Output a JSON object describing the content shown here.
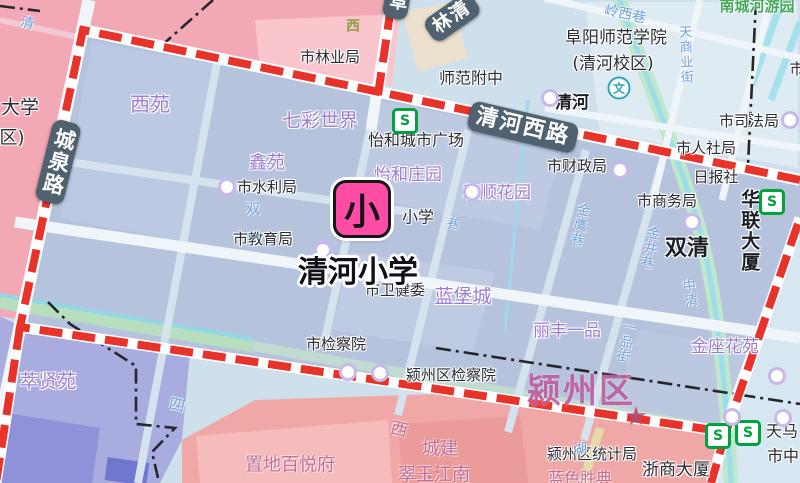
{
  "map": {
    "school_label": "清河小学",
    "marker": {
      "char": "小"
    },
    "colors": {
      "boundary_red": "#e8332b",
      "district_fill": "#b5c3dd",
      "base_lightblue": "#cfe0ed",
      "pink_northwest": "#f2a9b5",
      "salmon_south": "#f0a8a6",
      "purple_southwest": "#a8acde",
      "marker_pink": "#ff4da6",
      "pill_bg": "#50626f",
      "residential_purple": "#9d7bd0",
      "street_blue": "#6fa0dc",
      "metro_green": "#00a33e",
      "park_green": "#b7dfbf",
      "water_cyan": "#93d6e6"
    },
    "labels": [
      {
        "n": "road-pill-chengquanlu",
        "t": "城泉路",
        "cls": "pill",
        "x": 58,
        "y": 162,
        "s": 21,
        "r": 14,
        "v": true,
        "i": false
      },
      {
        "n": "road-pill-qinghexilu",
        "t": "清河西路",
        "cls": "pill",
        "x": 523,
        "y": 127,
        "s": 22,
        "r": 13,
        "i": false
      },
      {
        "n": "road-pill-linqing",
        "t": "林清",
        "cls": "pill",
        "x": 452,
        "y": 17,
        "s": 19,
        "r": -35,
        "i": false
      },
      {
        "n": "road-pill-fu",
        "t": "阜",
        "cls": "pill",
        "x": 397,
        "y": 2,
        "s": 18,
        "r": 10,
        "v": true,
        "i": false
      },
      {
        "n": "poi-shilinyeju",
        "t": "市林业局",
        "cls": "poi",
        "x": 330,
        "y": 57,
        "i": true
      },
      {
        "n": "poi-shifanfuzhong",
        "t": "师范附中",
        "cls": "poi",
        "x": 471,
        "y": 78,
        "s": 16,
        "i": true
      },
      {
        "n": "poi-qinghe",
        "t": "清河",
        "cls": "poib",
        "x": 572,
        "y": 103,
        "s": 17,
        "i": true
      },
      {
        "n": "poi-fuyangshifanxueyuan",
        "t": "阜阳师范学院",
        "cls": "poi",
        "x": 616,
        "y": 38,
        "s": 17,
        "i": true
      },
      {
        "n": "poi-qinghexiaoqu",
        "t": "(清河校区)",
        "cls": "poi",
        "x": 613,
        "y": 64,
        "s": 17,
        "i": true
      },
      {
        "n": "poi-shisifaju",
        "t": "市司法局",
        "cls": "poi",
        "x": 749,
        "y": 121,
        "i": true
      },
      {
        "n": "poi-shirensheju",
        "t": "市人社局",
        "cls": "poi",
        "x": 706,
        "y": 148,
        "i": true
      },
      {
        "n": "poi-ribaoshe",
        "t": "日报社",
        "cls": "poi",
        "x": 716,
        "y": 177,
        "i": true
      },
      {
        "n": "poi-shicaizhengju",
        "t": "市财政局",
        "cls": "poi",
        "x": 577,
        "y": 166,
        "i": true
      },
      {
        "n": "poi-shishangwuju",
        "t": "市商务局",
        "cls": "poi",
        "x": 667,
        "y": 201,
        "i": true
      },
      {
        "n": "poi-shuangqing",
        "t": "双清",
        "cls": "poib",
        "x": 687,
        "y": 249,
        "s": 22,
        "i": true
      },
      {
        "n": "poi-hualiandasha",
        "t": "华联大厦",
        "cls": "poib",
        "x": 749,
        "y": 231,
        "s": 19,
        "v": true,
        "i": true
      },
      {
        "n": "poi-shishuiliju",
        "t": "市水利局",
        "cls": "poi",
        "x": 267,
        "y": 187,
        "i": true
      },
      {
        "n": "poi-shijiaoyuju",
        "t": "市教育局",
        "cls": "poi",
        "x": 263,
        "y": 239,
        "i": true
      },
      {
        "n": "poi-yihechengshiguangchang",
        "t": "怡和城市广场",
        "cls": "poi",
        "x": 416,
        "y": 140,
        "s": 16,
        "i": true
      },
      {
        "n": "poi-xiaoxue-partial",
        "t": "小学",
        "cls": "poi",
        "x": 418,
        "y": 217,
        "s": 16,
        "i": true
      },
      {
        "n": "poi-shiweijianwei",
        "t": "市卫健委",
        "cls": "poi",
        "x": 395,
        "y": 290,
        "i": true
      },
      {
        "n": "poi-shijianchayuan",
        "t": "市检察院",
        "cls": "poi",
        "x": 336,
        "y": 344,
        "i": true
      },
      {
        "n": "poi-yingzhouqujianchayuan",
        "t": "颍州区检察院",
        "cls": "poi",
        "x": 451,
        "y": 375,
        "i": true
      },
      {
        "n": "poi-yingzhouqutongjiju",
        "t": "颍州区统计局",
        "cls": "poi",
        "x": 592,
        "y": 454,
        "i": true
      },
      {
        "n": "poi-zheshangdasha",
        "t": "浙商大厦",
        "cls": "poi",
        "x": 676,
        "y": 470,
        "s": 17,
        "i": true
      },
      {
        "n": "poi-tianma",
        "t": "天马",
        "cls": "poi",
        "x": 782,
        "y": 431,
        "s": 16,
        "i": true
      },
      {
        "n": "poi-shizhong",
        "t": "市中",
        "cls": "poi",
        "x": 783,
        "y": 456,
        "s": 16,
        "i": true
      },
      {
        "n": "poi-shi-partial",
        "t": "市",
        "cls": "poi",
        "x": 797,
        "y": 69,
        "i": true
      },
      {
        "n": "poi-daxue-partial",
        "t": "大学",
        "cls": "poi",
        "x": 20,
        "y": 108,
        "s": 19,
        "i": false
      },
      {
        "n": "poi-qu-partial",
        "t": "区)",
        "cls": "poi",
        "x": 12,
        "y": 138,
        "s": 18,
        "i": false
      },
      {
        "n": "res-xiyuan",
        "t": "西苑",
        "cls": "res",
        "x": 150,
        "y": 105,
        "s": 20,
        "i": true
      },
      {
        "n": "res-qicaishijie",
        "t": "七彩世界",
        "cls": "res",
        "x": 320,
        "y": 121,
        "s": 19,
        "i": true
      },
      {
        "n": "res-xinyuan",
        "t": "鑫苑",
        "cls": "res",
        "x": 267,
        "y": 163,
        "s": 18,
        "i": true
      },
      {
        "n": "res-yihezhuangyuan",
        "t": "怡和庄园",
        "cls": "res",
        "x": 408,
        "y": 175,
        "s": 17,
        "i": true
      },
      {
        "n": "res-heshunhuayuan",
        "t": "和顺花园",
        "cls": "res",
        "x": 497,
        "y": 193,
        "s": 17,
        "i": true
      },
      {
        "n": "res-lanbaocheng",
        "t": "蓝堡城",
        "cls": "res",
        "x": 463,
        "y": 297,
        "s": 19,
        "i": true
      },
      {
        "n": "res-lifengyipin",
        "t": "丽丰一品",
        "cls": "res",
        "x": 567,
        "y": 331,
        "s": 17,
        "i": true
      },
      {
        "n": "res-jinzuohuayuan",
        "t": "金座花苑",
        "cls": "res",
        "x": 725,
        "y": 347,
        "s": 17,
        "i": true
      },
      {
        "n": "res-cuixianyuan",
        "t": "萃贤苑",
        "cls": "res",
        "x": 48,
        "y": 382,
        "s": 19,
        "i": true
      },
      {
        "n": "res-zhidibaiyuefu",
        "t": "置地百悦府",
        "cls": "mauve",
        "x": 290,
        "y": 465,
        "s": 18,
        "i": true
      },
      {
        "n": "res-chengjian",
        "t": "城建",
        "cls": "mauve",
        "x": 440,
        "y": 449,
        "s": 18,
        "i": true
      },
      {
        "n": "res-cuiyujiangnan",
        "t": "翠玉江南",
        "cls": "mauve",
        "x": 434,
        "y": 475,
        "s": 18,
        "i": true
      },
      {
        "n": "res-lanseshengdian",
        "t": "蓝色胜典",
        "cls": "mauve",
        "x": 580,
        "y": 478,
        "s": 16,
        "i": true
      },
      {
        "n": "district-label-yingzhouqu",
        "t": "颍州区",
        "cls": "district",
        "x": 581,
        "y": 392,
        "s": 34,
        "i": false
      },
      {
        "n": "street-qing",
        "t": "清",
        "cls": "street",
        "x": 27,
        "y": 24,
        "s": 14,
        "r": 15,
        "i": false
      },
      {
        "n": "street-lingxixiang",
        "t": "岭西巷",
        "cls": "street",
        "x": 625,
        "y": 15,
        "s": 14,
        "r": 12,
        "i": false
      },
      {
        "n": "street-tianshangyejie",
        "t": "天商业街",
        "cls": "street",
        "x": 684,
        "y": 55,
        "s": 13,
        "r": -2,
        "v": true,
        "i": false
      },
      {
        "n": "street-jinyingxiang",
        "t": "金鹰巷",
        "cls": "street",
        "x": 578,
        "y": 225,
        "s": 13,
        "r": 12,
        "v": true,
        "i": false
      },
      {
        "n": "street-jinjingxiang",
        "t": "金井巷",
        "cls": "street",
        "x": 648,
        "y": 248,
        "s": 13,
        "r": 12,
        "v": true,
        "i": false
      },
      {
        "n": "street-zhongqing",
        "t": "中清",
        "cls": "street",
        "x": 688,
        "y": 294,
        "s": 13,
        "r": -8,
        "v": true,
        "i": false
      },
      {
        "n": "street-yipinjie",
        "t": "一品街",
        "cls": "street",
        "x": 624,
        "y": 342,
        "s": 13,
        "r": 12,
        "v": true,
        "i": false
      },
      {
        "n": "street-si",
        "t": "四",
        "cls": "street",
        "x": 177,
        "y": 405,
        "s": 16,
        "r": 14,
        "i": false
      },
      {
        "n": "street-hu",
        "t": "湖",
        "cls": "street",
        "x": 580,
        "y": 450,
        "s": 14,
        "i": false
      },
      {
        "n": "street-shuang",
        "t": "双",
        "cls": "street",
        "x": 253,
        "y": 210,
        "s": 14,
        "i": false
      },
      {
        "n": "street-xiang",
        "t": "巷",
        "cls": "street",
        "x": 453,
        "y": 224,
        "s": 12,
        "r": 14,
        "i": false
      },
      {
        "n": "street-xi-olive",
        "t": "西",
        "cls": "olive",
        "x": 353,
        "y": 27,
        "s": 14,
        "i": false
      },
      {
        "n": "street-xi-mauve",
        "t": "西",
        "cls": "mauve",
        "x": 399,
        "y": 430,
        "s": 17,
        "r": 14,
        "i": false
      },
      {
        "n": "park-nanchenghe",
        "t": "南城河游园",
        "cls": "green",
        "x": 757,
        "y": 6,
        "s": 15,
        "i": false
      }
    ],
    "icons": [
      {
        "type": "s",
        "n": "metro-station-icon",
        "x": 405,
        "y": 121
      },
      {
        "type": "s",
        "n": "metro-station-icon",
        "x": 772,
        "y": 202
      },
      {
        "type": "s",
        "n": "metro-station-icon",
        "x": 718,
        "y": 436
      },
      {
        "type": "s",
        "n": "metro-station-icon",
        "x": 748,
        "y": 433
      },
      {
        "type": "wen",
        "n": "school-symbol-icon",
        "x": 619,
        "y": 88
      },
      {
        "type": "star",
        "n": "district-star-icon",
        "x": 636,
        "y": 417
      },
      {
        "type": "xx",
        "n": "bridge-symbol-icon",
        "x": 254,
        "y": 237
      },
      {
        "type": "dot",
        "n": "poi-dot-icon",
        "x": 227,
        "y": 187
      },
      {
        "type": "dot",
        "n": "poi-dot-icon",
        "x": 620,
        "y": 170
      },
      {
        "type": "dot",
        "n": "poi-dot-icon",
        "x": 692,
        "y": 222
      },
      {
        "type": "dot",
        "n": "poi-dot-icon",
        "x": 790,
        "y": 120
      },
      {
        "type": "dot",
        "n": "poi-dot-icon",
        "x": 348,
        "y": 372
      },
      {
        "type": "dot",
        "n": "poi-dot-icon",
        "x": 380,
        "y": 373
      },
      {
        "type": "dot",
        "n": "poi-dot-icon",
        "x": 323,
        "y": 250
      },
      {
        "type": "dot",
        "n": "poi-dot-icon",
        "x": 732,
        "y": 417
      },
      {
        "type": "dot",
        "n": "poi-dot-icon",
        "x": 783,
        "y": 418
      },
      {
        "type": "dot",
        "n": "poi-dot-icon",
        "x": 777,
        "y": 376
      },
      {
        "type": "dot",
        "n": "poi-dot-icon",
        "x": 550,
        "y": 98
      },
      {
        "type": "dot",
        "n": "poi-dot-icon",
        "x": 472,
        "y": 192
      }
    ]
  }
}
